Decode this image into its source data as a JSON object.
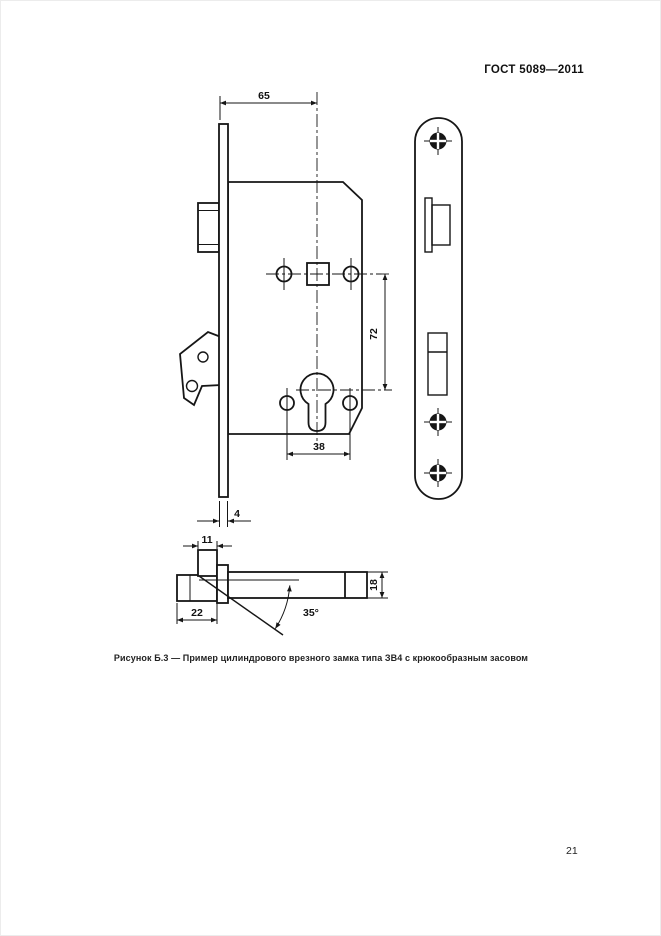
{
  "page": {
    "header": "ГОСТ 5089—2011",
    "number": "21",
    "background": "#ffffff",
    "ink": "#161616"
  },
  "figure": {
    "caption": "Рисунок Б.3 — Пример цилиндрового врезного замка типа ЗВ4 с крюкообразным засовом",
    "dimensions": {
      "backset": "65",
      "handle_to_cylinder": "72",
      "fixing_hole_spacing": "38",
      "faceplate_thickness": "4",
      "hook_bolt_width": "11",
      "hook_bolt_depth": "22",
      "bolt_thickness": "18",
      "hook_swing_angle": "35°"
    }
  }
}
